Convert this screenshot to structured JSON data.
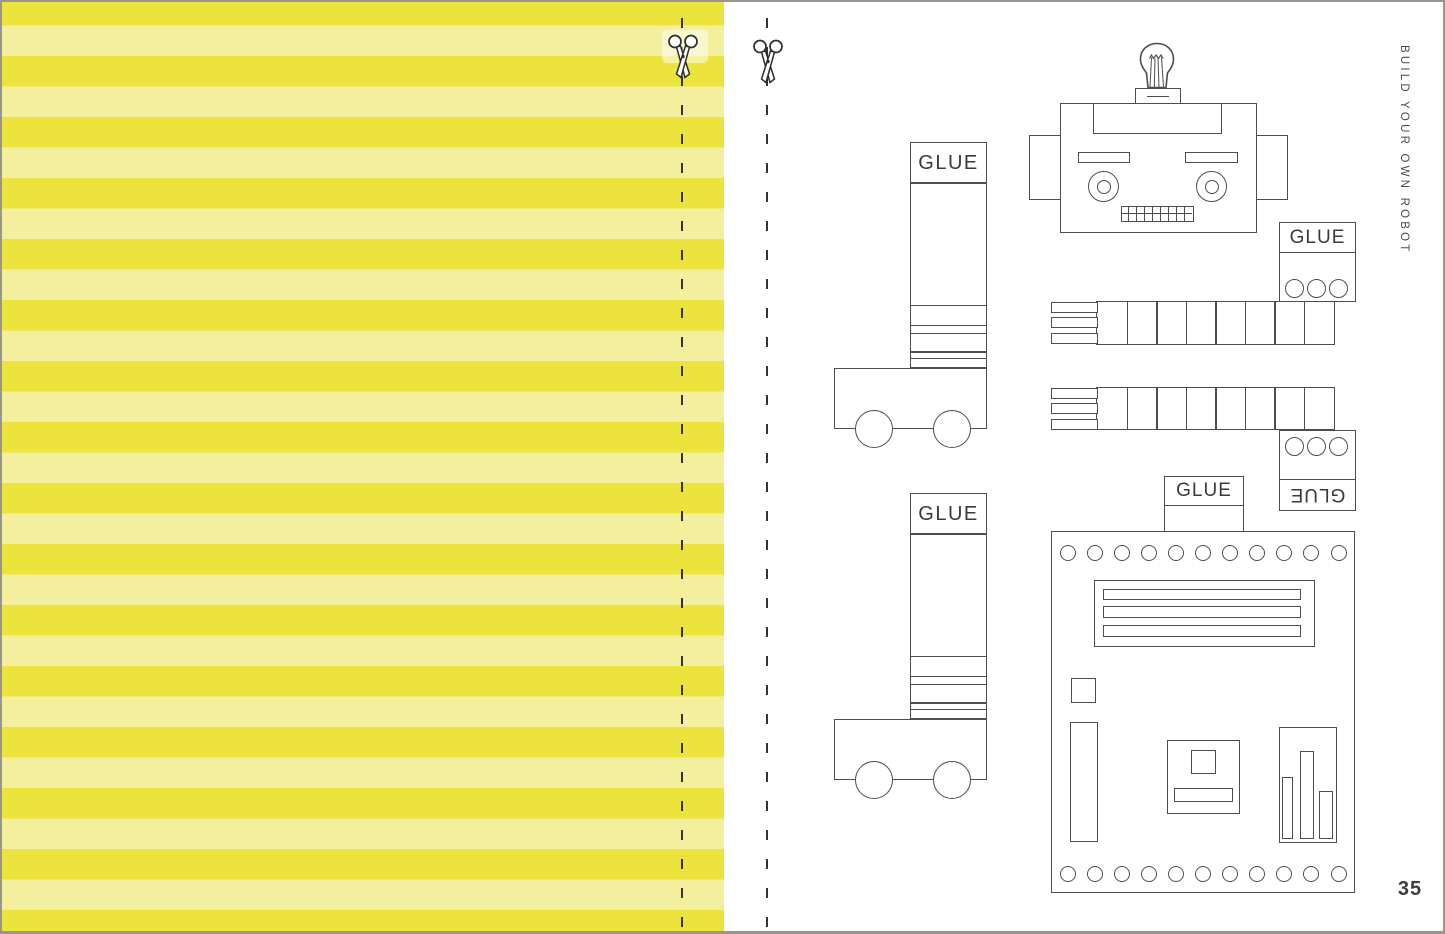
{
  "page": {
    "side_title": "BUILD YOUR OWN ROBOT",
    "number": "35"
  },
  "glue_label": "GLUE",
  "colors": {
    "stripe_bright": "#ece43d",
    "stripe_pale": "#f3ef9d",
    "outline": "#4d4d4d"
  },
  "shapes": {
    "body_rivet_count": 11,
    "arm_segment_count": 8,
    "finger_tab_count": 3,
    "hand_hole_count": 3
  }
}
